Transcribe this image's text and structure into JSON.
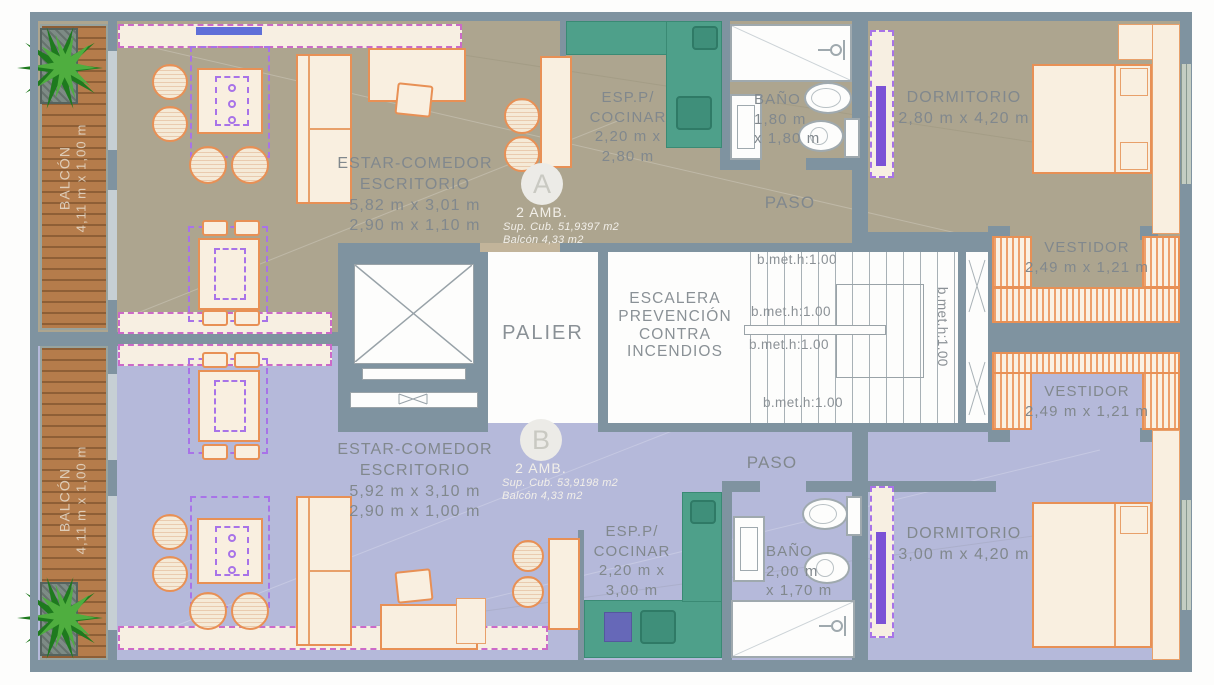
{
  "plan": {
    "unit_a": {
      "badge": "A",
      "type": "2 AMB.",
      "sup_cub": "Sup. Cub. 51,9397 m2",
      "sup_balcon": "Balcón 4,33 m2",
      "estar": [
        "ESTAR-COMEDOR",
        "ESCRITORIO",
        "5,82 m x 3,01 m",
        "2,90 m x 1,10 m"
      ],
      "cocina": [
        "ESP.P/",
        "COCINAR",
        "2,20 m x",
        "2,80 m"
      ],
      "bano": [
        "BAÑO",
        "1,80 m",
        "x 1,80 m"
      ],
      "paso": "PASO",
      "dormitorio": [
        "DORMITORIO",
        "2,80 m x 4,20 m"
      ],
      "vestidor": [
        "VESTIDOR",
        "2,49 m x 1,21 m"
      ],
      "balcon": [
        "BALCÓN",
        "4,11 m x 1,00 m"
      ]
    },
    "unit_b": {
      "badge": "B",
      "type": "2 AMB.",
      "sup_cub": "Sup. Cub. 53,9198 m2",
      "sup_balcon": "Balcón 4,33 m2",
      "estar": [
        "ESTAR-COMEDOR",
        "ESCRITORIO",
        "5,92 m x 3,10 m",
        "2,90 m x 1,00 m"
      ],
      "cocina": [
        "ESP.P/",
        "COCINAR",
        "2,20 m x",
        "3,00 m"
      ],
      "bano": [
        "BAÑO",
        "2,00 m",
        "x 1,70 m"
      ],
      "paso": "PASO",
      "dormitorio": [
        "DORMITORIO",
        "3,00 m x 4,20 m"
      ],
      "vestidor": [
        "VESTIDOR",
        "2,49 m x 1,21 m"
      ],
      "balcon": [
        "BALCÓN",
        "4,11 m x 1,00 m"
      ]
    },
    "core": {
      "palier": "PALIER",
      "escalera": [
        "ESCALERA",
        "PREVENCIÓN",
        "CONTRA",
        "INCENDIOS"
      ],
      "stair_marks": [
        "b.met.h:1.00",
        "b.met.h:1.00",
        "b.met.h:1.00",
        "b.met.h:1.00"
      ],
      "stair_mark_side": "b.met.h:1.00"
    },
    "colors": {
      "floor_unit_a": "#ada58f",
      "floor_unit_b": "#b5b9da",
      "walls": "#7f93a0",
      "kitchen_counter": "#4ea08a",
      "balcony_wood": "#b57c4b",
      "furniture_outline": "#e89055",
      "closet_hatch": "#eda06c",
      "label_gray": "#81888d",
      "label_white": "#f2efe9",
      "accent_purple": "#a873e8",
      "window_blue": "#5f6fd8"
    }
  }
}
